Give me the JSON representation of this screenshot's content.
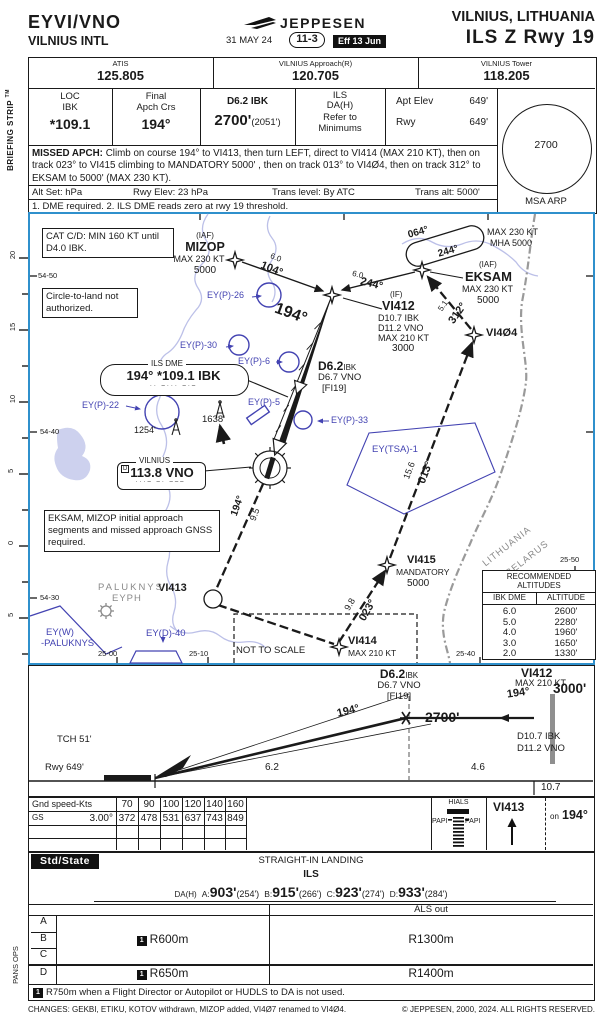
{
  "header": {
    "icao": "EYVI/VNO",
    "airport": "VILNIUS INTL",
    "logo": "JEPPESEN",
    "date": "31 MAY 24",
    "index": "11-3",
    "effective": "Eff 13 Jun",
    "city": "VILNIUS, LITHUANIA",
    "procedure": "ILS Z Rwy 19"
  },
  "strip": {
    "label": "BRIEFING STRIP",
    "tm": "TM",
    "pans_ops": "PANS OPS"
  },
  "comms": {
    "c1l": "ATIS",
    "c1v": "125.805",
    "c2l": "VILNIUS Approach(R)",
    "c2v": "120.705",
    "c3l": "VILNIUS Tower",
    "c3v": "118.205"
  },
  "brief": {
    "loc1": "LOC",
    "loc2": "IBK",
    "locv": "*109.1",
    "fin1": "Final",
    "fin2": "Apch Crs",
    "finv": "194°",
    "fix": "D6.2 IBK",
    "fixv": "2700'",
    "fixp": "(2051')",
    "ils1": "ILS",
    "ils2": "DA(H)",
    "ils3": "Refer to",
    "ils4": "Minimums",
    "aptl": "Apt Elev",
    "aptv": "649'",
    "rwyl": "Rwy",
    "rwyv": "649'",
    "msa": "2700",
    "msal": "MSA ARP",
    "mal": "MISSED APCH:",
    "ma": "Climb on course 194° to VI413, then turn LEFT, direct to VI414 (MAX 210 KT), then on track 023° to VI415 climbing to MANDATORY 5000' , then on track 013° to VI4Ø4, then on track 312° to EKSAM to 5000' (MAX 230 KT).",
    "alt1": "Alt Set: hPa",
    "alt2": "Rwy Elev: 23 hPa",
    "alt3": "Trans level: By ATC",
    "alt4": "Trans alt: 5000'",
    "notes": "1. DME required.  2. ILS DME reads zero at rwy 19 threshold."
  },
  "map": {
    "cat_box": "CAT C/D: MIN 160 KT until D4.0 IBK.",
    "circle_box": "Circle-to-land not authorized.",
    "gnss_box": "EKSAM, MIZOP initial approach segments and missed approach GNSS required.",
    "mizop_iaf": "(IAF)",
    "mizop": "MIZOP",
    "mizop1": "MAX 230 KT",
    "mizop2": "5000",
    "leg1d": "6.0",
    "leg1c": "104°",
    "leg2d": "6.0",
    "leg2c": "244°",
    "hold1": "064°",
    "hold2": "244°",
    "hold3": "MAX 230 KT",
    "hold4": "MHA 5000",
    "eksam_iaf": "(IAF)",
    "eksam": "EKSAM",
    "eksam1": "MAX 230 KT",
    "eksam2": "5000",
    "vi412_if": "(IF)",
    "vi412": "VI412",
    "vi412a": "D10.7 IBK",
    "vi412b": "D11.2 VNO",
    "vi412c": "MAX 210 KT",
    "vi412d": "3000",
    "leg3d": "5.1",
    "leg3c": "312°",
    "vi404": "VI4Ø4",
    "crs_big": "194°",
    "d62": "D6.2",
    "d62u": "IBK",
    "d62a": "D6.7 VNO",
    "d62b": "[FI19]",
    "ilsdme_t": "ILS DME",
    "ilsdme": "194° *109.1 IBK",
    "ilsdme_m": "·· –··· –·–",
    "vor_t": "VILNIUS",
    "vor_d": "D",
    "vor": "113.8 VNO",
    "vor_m": "···– –· –––",
    "ey26": "EY(P)-26",
    "ey30": "EY(P)-30",
    "ey6": "EY(P)-6",
    "ey5": "EY(P)-5",
    "ey22": "EY(P)-22",
    "ey33": "EY(P)-33",
    "ob1": "1254'",
    "ob2": "1638'",
    "leg4c": "194°",
    "leg4d": "9.5",
    "vi413": "VI413",
    "vi414": "VI414",
    "vi414a": "MAX 210 KT",
    "leg5d": "9.8",
    "leg5c": "023°",
    "vi415": "VI415",
    "vi415a": "MANDATORY",
    "vi415b": "5000",
    "leg6d": "15.6",
    "leg6c": "013°",
    "tsa": "EY(TSA)-1",
    "cty1": "LITHUANIA",
    "cty2": "BELARUS",
    "paluknys": "PALUKNYS",
    "eyph": "EYPH",
    "eyw1": "EY(W)",
    "eyw2": "-PALUKNYS",
    "eyd": "EY(D)-40",
    "lat1": "54-50",
    "lat2": "54-40",
    "lat3": "54-30",
    "lon1": "25-00",
    "lon2": "25-10",
    "lon3": "25-40",
    "lon4": "25-50",
    "nts": "NOT TO SCALE",
    "scale": [
      "20",
      "15",
      "10",
      "5",
      "0",
      "5"
    ],
    "rec": {
      "t1": "RECOMMENDED",
      "t2": "ALTITUDES",
      "h1": "IBK DME",
      "h2": "ALTITUDE",
      "rows": [
        [
          "6.0",
          "2600'"
        ],
        [
          "5.0",
          "2280'"
        ],
        [
          "4.0",
          "1960'"
        ],
        [
          "3.0",
          "1650'"
        ],
        [
          "2.0",
          "1330'"
        ]
      ]
    }
  },
  "profile": {
    "d62": "D6.2",
    "d62u": "IBK",
    "d62a": "D6.7 VNO",
    "d62b": "[FI19]",
    "vi412": "VI412",
    "vi412a": "MAX 210 KT",
    "vi412crs": "194°",
    "vi412alt": "3000'",
    "gp_crs": "194°",
    "gp_alt": "2700'",
    "lvl_crs": "194°",
    "tch": "TCH 51'",
    "rwy": "Rwy 649'",
    "dme1": "D10.7 IBK",
    "dme2": "D11.2 VNO",
    "d1": "6.2",
    "d2": "4.6",
    "total": "10.7"
  },
  "gs": {
    "r1l": "Gnd speed-Kts",
    "r1": [
      "70",
      "90",
      "100",
      "120",
      "140",
      "160"
    ],
    "r2l": "GS",
    "r2a": "3.00°",
    "r2": [
      "372",
      "478",
      "531",
      "637",
      "743",
      "849"
    ],
    "hials": "HIALS",
    "papi_l": "PAPI",
    "papi_r": "PAPI",
    "ma_fix": "VI413",
    "ma_on": "on",
    "ma_crs": "194°"
  },
  "min": {
    "std": "Std/State",
    "sil": "STRAIGHT-IN LANDING",
    "ils": "ILS",
    "dah": "DA(H)",
    "a": "A:",
    "av": "903'",
    "ap": "(254')",
    "b": "B:",
    "bv": "915'",
    "bp": "(266')",
    "c": "C:",
    "cv": "923'",
    "cp": "(274')",
    "d": "D:",
    "dv": "933'",
    "dp": "(284')",
    "als": "ALS out",
    "catA": "A",
    "catB": "B",
    "catC": "C",
    "catD": "D",
    "n1": "1",
    "abc_l": "R600m",
    "abc_r": "R1300m",
    "d_l": "R650m",
    "d_r": "R1400m",
    "note": "R750m when a Flight Director or Autopilot or HUDLS to DA is not used."
  },
  "footer": {
    "changes": "CHANGES: GEKBI, ETIKU, KOTOV withdrawn, MIZOP added, VI4Ø7 renamed to VI4Ø4.",
    "copyright": "© JEPPESEN, 2000, 2024. ALL RIGHTS RESERVED."
  }
}
